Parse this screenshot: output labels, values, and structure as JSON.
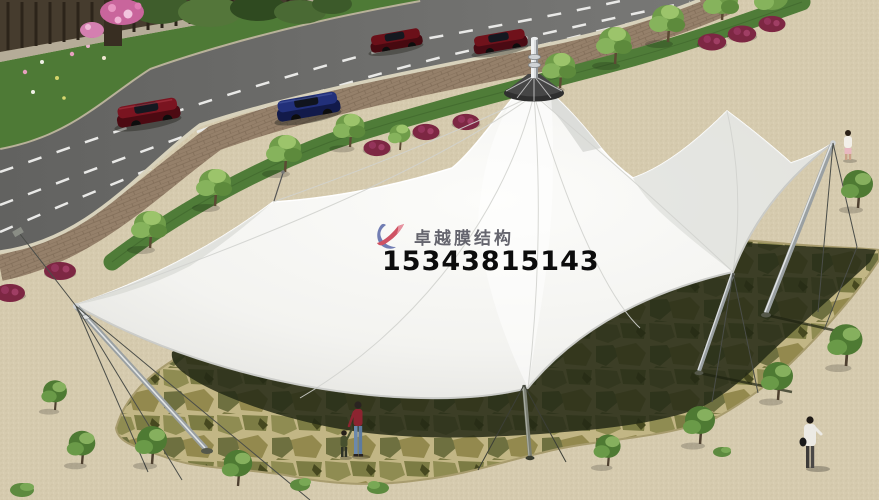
{
  "watermark": {
    "brand": "卓越膜结构",
    "phone": "15343815143",
    "brand_color": "#4b4b56",
    "phone_color": "#0c0c0c",
    "logo_red": "#c8364a",
    "logo_blue": "#5a68a8"
  },
  "scene": {
    "subject": "white tensile membrane canopy structure over a flagstone plaza beside a curved road",
    "cars": [
      {
        "name": "car-dark-red",
        "color": "#7a1420"
      },
      {
        "name": "car-dark-blue",
        "color": "#22307a"
      },
      {
        "name": "car-dark-red-2",
        "color": "#6b1019"
      },
      {
        "name": "car-dark-red-3",
        "color": "#70121b"
      }
    ],
    "people_count": 4,
    "palette": {
      "road": "#6f6f6d",
      "pavement": "#d6cbaf",
      "grass": "#4f7c38",
      "flagstone_grout": "#c2b685",
      "canopy_shadow": "#232815",
      "membrane": "#f6f6f3",
      "mast": "#9aa0a2"
    }
  }
}
